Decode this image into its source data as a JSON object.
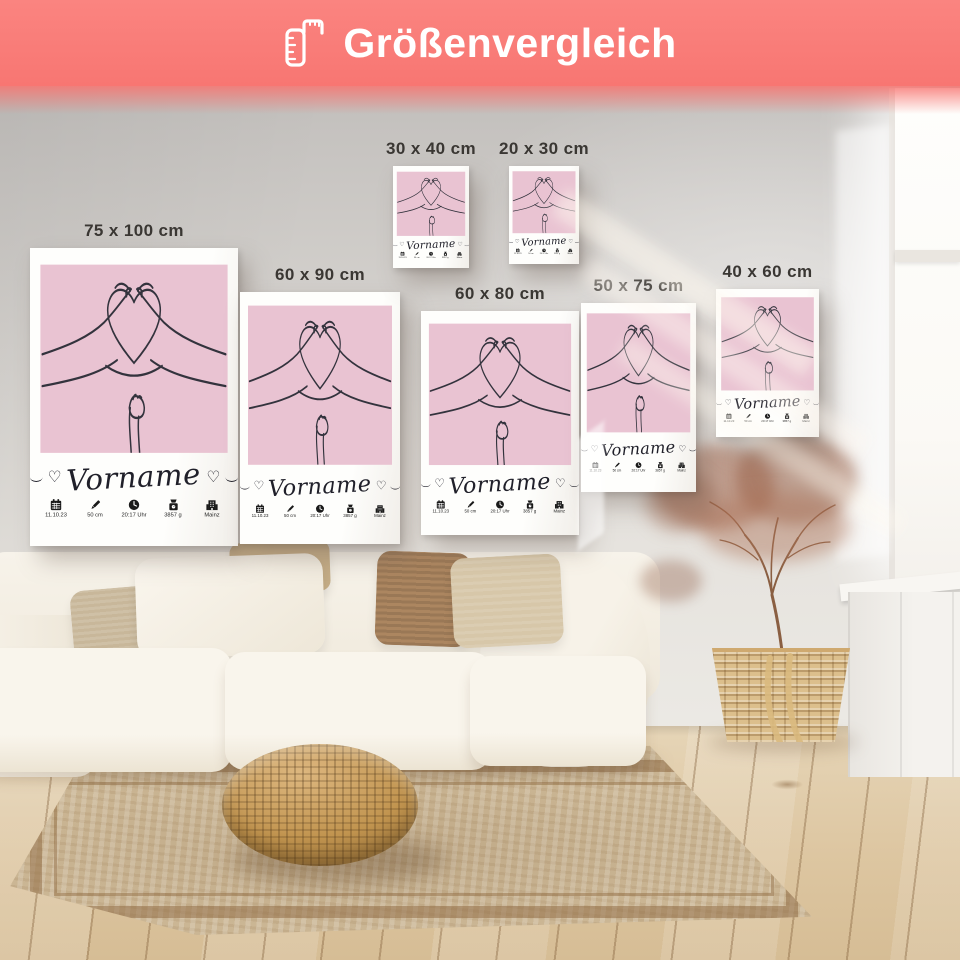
{
  "header": {
    "title": "Größenvergleich",
    "icon": "ruler-icon",
    "background_color": "#f87672",
    "text_color": "#ffffff"
  },
  "poster_design": {
    "art": "line art of two hands forming a heart above a baby hand",
    "background_color": "#e9c3d2",
    "name_text": "Vorname",
    "details": [
      {
        "icon": "calendar-icon",
        "label": "11.10.23"
      },
      {
        "icon": "pencil-icon",
        "label": "50 cm"
      },
      {
        "icon": "clock-icon",
        "label": "20:17 Uhr"
      },
      {
        "icon": "scale-icon",
        "label": "3857 g"
      },
      {
        "icon": "hospital-icon",
        "label": "Mainz"
      }
    ]
  },
  "posters": [
    {
      "size_label": "75 x 100 cm"
    },
    {
      "size_label": "60 x 90 cm"
    },
    {
      "size_label": "30 x 40 cm"
    },
    {
      "size_label": "20 x 30 cm"
    },
    {
      "size_label": "60 x 80 cm"
    },
    {
      "size_label": "50 x 75 cm"
    },
    {
      "size_label": "40 x 60 cm"
    }
  ]
}
